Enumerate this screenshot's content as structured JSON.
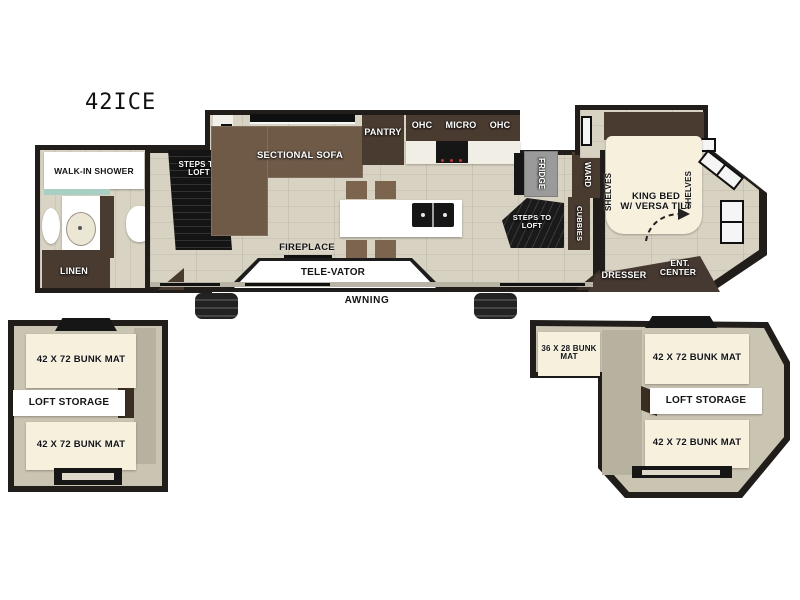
{
  "title": "42ICE",
  "colors": {
    "wall": "#201d1a",
    "floor": "#d8d2c2",
    "dark_wood": "#4a3b31",
    "sofa_brown": "#6f5a48",
    "cream_mat": "#f6f0dd",
    "fridge_gray": "#9a9a9a",
    "loft_tan": "#cac4b2",
    "shower_glass": "#a9cfc4",
    "white": "#ffffff"
  },
  "main_floor": {
    "bath": {
      "shower": "WALK-IN SHOWER",
      "washer": "WASHER DRYER PREP",
      "linen": "LINEN"
    },
    "living": {
      "steps_front": "STEPS TO LOFT",
      "sofa": "SECTIONAL SOFA",
      "pantry": "PANTRY",
      "ohc_left": "OHC",
      "micro": "MICRO",
      "ohc_right": "OHC",
      "fireplace": "FIREPLACE",
      "televator": "TELE-VATOR",
      "fridge": "FRIDGE",
      "ward": "WARD",
      "steps_rear": "STEPS TO LOFT",
      "cubbies": "CUBBIES",
      "awning": "AWNING"
    },
    "bedroom": {
      "shelves_left": "SHELVES",
      "shelves_right": "SHELVES",
      "king_bed_line1": "KING BED",
      "king_bed_line2": "W/ VERSA TILT",
      "dresser": "DRESSER",
      "ent_line1": "ENT.",
      "ent_line2": "CENTER"
    }
  },
  "loft_left": {
    "bunk_top": "42 X 72 BUNK MAT",
    "storage": "LOFT STORAGE",
    "bunk_bottom": "42 X 72 BUNK MAT"
  },
  "loft_right": {
    "bunk_small": "36 X 28 BUNK MAT",
    "bunk_top": "42 X 72 BUNK MAT",
    "storage": "LOFT STORAGE",
    "bunk_bottom": "42 X 72 BUNK MAT"
  }
}
